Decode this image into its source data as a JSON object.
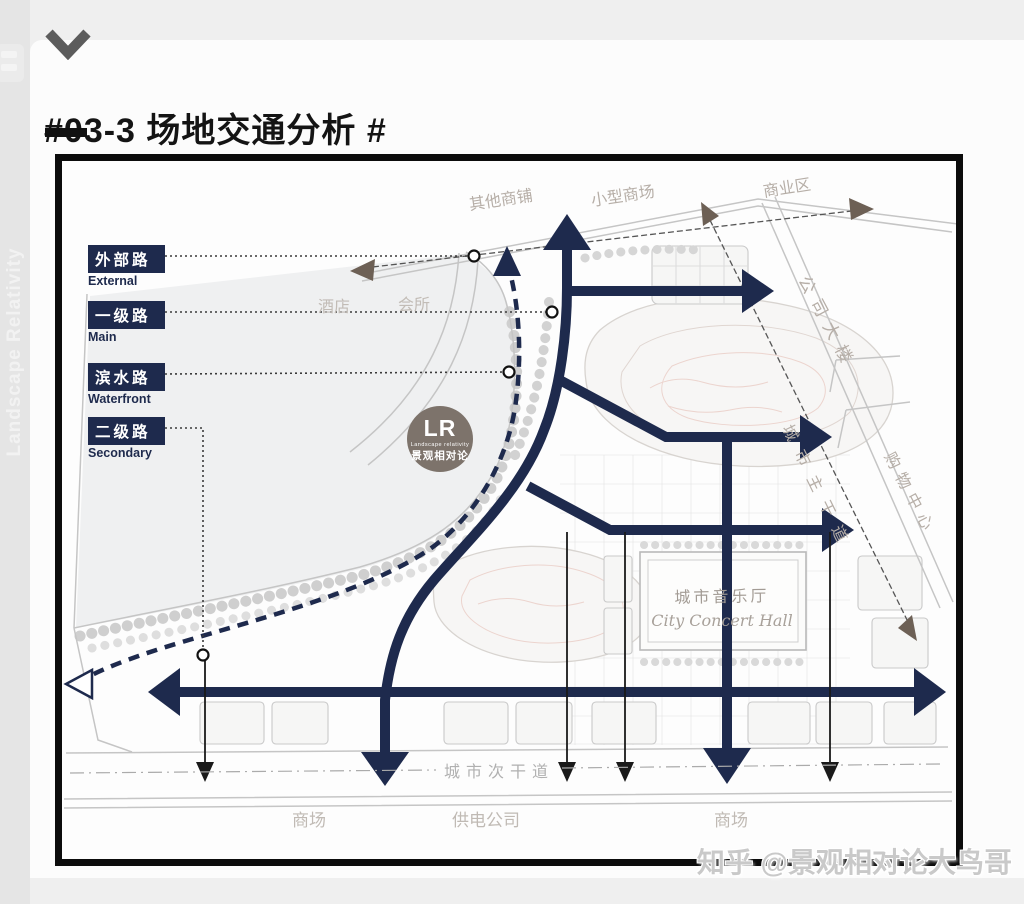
{
  "page": {
    "side_text": "Landscape Relativity",
    "watermark": "知乎 @景观相对论大鸟哥"
  },
  "header": {
    "title": "#03-3 场地交通分析 #"
  },
  "legend": {
    "items": [
      {
        "zh": "外部路",
        "en": "External"
      },
      {
        "zh": "一级路",
        "en": "Main"
      },
      {
        "zh": "滨水路",
        "en": "Waterfront"
      },
      {
        "zh": "二级路",
        "en": "Secondary"
      }
    ]
  },
  "map": {
    "top_labels": {
      "other_shops": "其他商铺",
      "small_mall": "小型商场",
      "commercial_district": "商业区"
    },
    "mid_labels": {
      "hotel": "酒店",
      "club": "会所"
    },
    "right_labels": {
      "company_building": "公司大楼",
      "city_main_road": "城市主干道",
      "shopping_center": "购物中心"
    },
    "bottom_labels": {
      "city_secondary_road": "城市次干道",
      "mall_left": "商场",
      "power_company": "供电公司",
      "mall_right": "商场"
    },
    "concert_hall": {
      "zh": "城市音乐厅",
      "en": "City Concert Hall"
    },
    "logo": {
      "initials": "LR",
      "name_en": "Landscape relativity",
      "name_zh": "景观相对论"
    }
  },
  "colors": {
    "navy": "#1e2a4d",
    "external_arrow": "#6d6055",
    "logo_circle": "#7d736b",
    "plan_linework": "#c5c5c5",
    "plan_label": "#b6aea7"
  }
}
